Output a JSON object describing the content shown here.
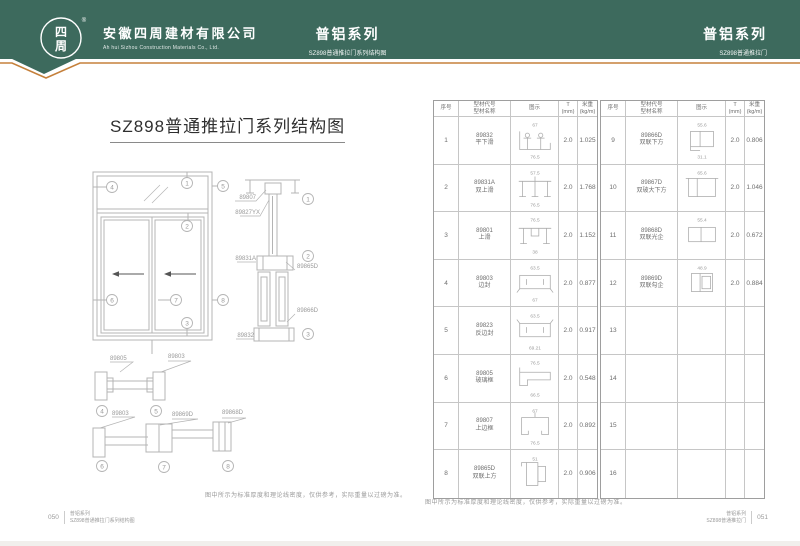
{
  "header": {
    "company_name": "安徽四周建材有限公司",
    "company_name_en": "Ah hui Sizhou Construction Materials Co., Ltd.",
    "logo_char_top": "四",
    "logo_char_bottom": "周",
    "registered_mark": "®",
    "center": {
      "title": "普铝系列",
      "subtitle": "SZ898普通推拉门系列结构图"
    },
    "right": {
      "title": "普铝系列",
      "subtitle": "SZ898普通推拉门"
    },
    "colors": {
      "band": "#3d6a5d",
      "accent": "#c5803b"
    }
  },
  "left_page": {
    "title": "SZ898普通推拉门系列结构图",
    "note": "图中所示为标准厚度和理论线密度，仅供参考，实际重量以过磅为准。",
    "footer": {
      "page_no": "050",
      "series": "普铝系列",
      "doc": "SZ898普通推拉门系列结构图"
    },
    "diagram": {
      "marks": [
        "1",
        "2",
        "3",
        "4",
        "5",
        "6",
        "7",
        "8"
      ],
      "labels": {
        "v1": "89807",
        "v2": "89827YX",
        "v3": "89831A",
        "v4": "89865D",
        "v5": "89866D",
        "v6": "89832",
        "h1": "89805",
        "h2": "89803",
        "h3": "89803",
        "h4": "89869D",
        "h5": "89868D"
      }
    }
  },
  "right_page": {
    "note": "图中所示为标准厚度和理论线密度，仅供参考，实际重量以过磅为准。",
    "footer": {
      "page_no": "051",
      "series": "普铝系列",
      "doc": "SZ898普通推拉门"
    },
    "table_headers": {
      "no": "序号",
      "code_line1": "型材代号",
      "code_line2": "型材名称",
      "diagram": "图示",
      "t_line1": "T",
      "t_line2": "(mm)",
      "w_line1": "米重",
      "w_line2": "(kg/m)"
    },
    "rows": [
      {
        "no": "1",
        "code": "89832",
        "name": "平下滑",
        "t": "2.0",
        "weight": "1.025",
        "shape": "bottom_track",
        "dim_top": "67",
        "dim_bottom": "76.5"
      },
      {
        "no": "2",
        "code": "89831A",
        "name": "双上滑",
        "t": "2.0",
        "weight": "1.768",
        "shape": "top_track_double",
        "dim_top": "57.5",
        "dim_bottom": "76.5"
      },
      {
        "no": "3",
        "code": "89801",
        "name": "上滑",
        "t": "2.0",
        "weight": "1.152",
        "shape": "top_track",
        "dim_top": "76.5",
        "dim_bottom": "38"
      },
      {
        "no": "4",
        "code": "89803",
        "name": "边封",
        "t": "2.0",
        "weight": "0.877",
        "shape": "edge_seal",
        "dim_top": "63.5",
        "dim_bottom": "67"
      },
      {
        "no": "5",
        "code": "89823",
        "name": "反边封",
        "t": "2.0",
        "weight": "0.917",
        "shape": "edge_seal_r",
        "dim_top": "63.5",
        "dim_bottom": "69.21"
      },
      {
        "no": "6",
        "code": "89805",
        "name": "玻璃框",
        "t": "2.0",
        "weight": "0.548",
        "shape": "glass_frame",
        "dim_top": "76.5",
        "dim_bottom": "66.5"
      },
      {
        "no": "7",
        "code": "89807",
        "name": "上边框",
        "t": "2.0",
        "weight": "0.892",
        "shape": "frame",
        "dim_top": "67",
        "dim_bottom": "76.5"
      },
      {
        "no": "8",
        "code": "89865D",
        "name": "双联上方",
        "t": "2.0",
        "weight": "0.906",
        "shape": "tube_top",
        "dim_top": "51",
        "dim_bottom": ""
      },
      {
        "no": "9",
        "code": "89866D",
        "name": "双联下方",
        "t": "2.0",
        "weight": "0.806",
        "shape": "tube_step",
        "dim_top": "55.6",
        "dim_bottom": "31.1"
      },
      {
        "no": "10",
        "code": "89867D",
        "name": "双玻大下方",
        "t": "2.0",
        "weight": "1.046",
        "shape": "tube_wide",
        "dim_top": "65.6",
        "dim_bottom": ""
      },
      {
        "no": "11",
        "code": "89868D",
        "name": "双联光企",
        "t": "2.0",
        "weight": "0.672",
        "shape": "tube_div",
        "dim_top": "55.4",
        "dim_bottom": ""
      },
      {
        "no": "12",
        "code": "89869D",
        "name": "双联勾企",
        "t": "2.0",
        "weight": "0.884",
        "shape": "tube_hook",
        "dim_top": "48.9",
        "dim_bottom": ""
      },
      {
        "no": "13"
      },
      {
        "no": "14"
      },
      {
        "no": "15"
      },
      {
        "no": "16"
      }
    ]
  }
}
